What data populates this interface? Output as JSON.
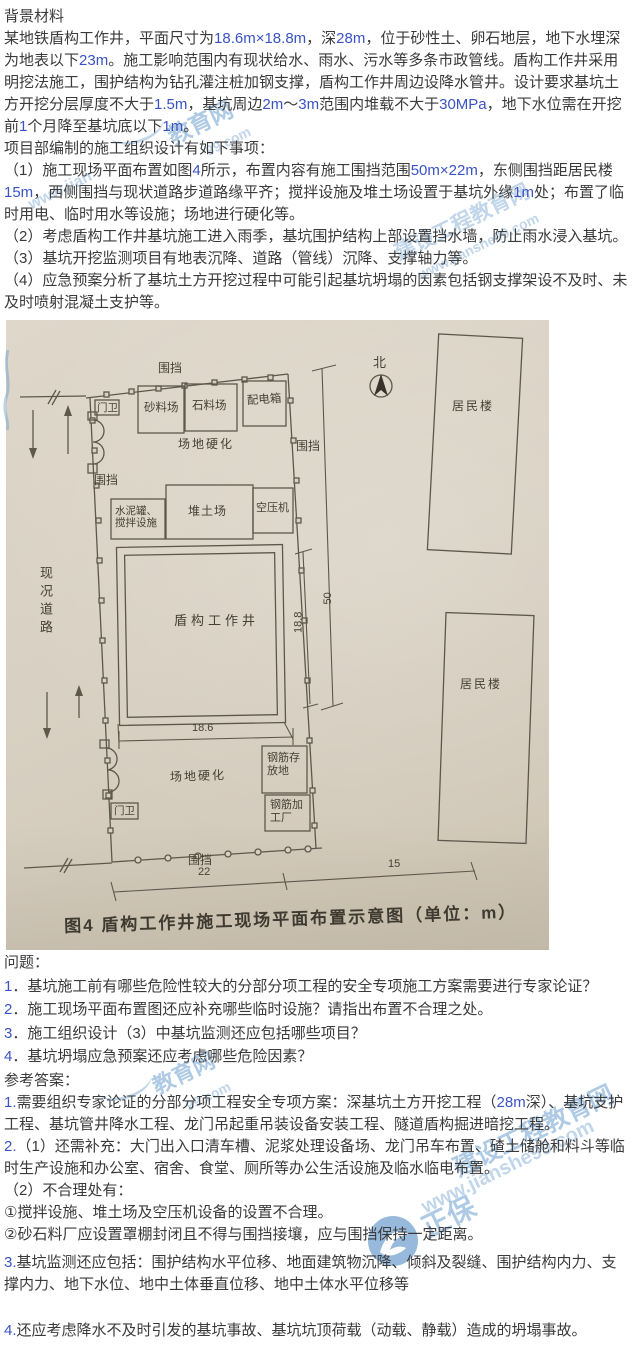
{
  "colors": {
    "accent_blue": "#3a53c4",
    "body_text": "#3a3a3a",
    "watermark_blue": "#6c9ece",
    "photo_paper": "#d8d0c2",
    "diagram_ink": "#5e584c"
  },
  "background": {
    "heading": "背景材料",
    "para1": [
      {
        "t": "某地铁盾构工作井，平面尺寸为"
      },
      {
        "t": "18.6m×18.8m",
        "b": true
      },
      {
        "t": "，深"
      },
      {
        "t": "28m",
        "b": true
      },
      {
        "t": "，位于砂性土、卵石地层，地下水埋深为地表以下"
      },
      {
        "t": "23m",
        "b": true
      },
      {
        "t": "。施工影响范围内有现状给水、雨水、污水等多条市政管线。盾构工作井采用明挖法施工，围护结构为钻孔灌注桩加钢支撑，盾构工作井周边设降水管井。设计要求基坑土方开挖分层厚度不大于"
      },
      {
        "t": "1.5m",
        "b": true
      },
      {
        "t": "，基坑周边"
      },
      {
        "t": "2m",
        "b": true
      },
      {
        "t": "～"
      },
      {
        "t": "3m",
        "b": true
      },
      {
        "t": "范围内堆载不大于"
      },
      {
        "t": "30MPa",
        "b": true
      },
      {
        "t": "，地下水位需在开挖前"
      },
      {
        "t": "1",
        "b": true
      },
      {
        "t": "个月降至基坑底以下"
      },
      {
        "t": "1m",
        "b": true
      },
      {
        "t": "。"
      }
    ],
    "para2": "项目部编制的施工组织设计有如下事项：",
    "item1": [
      {
        "t": "（1）施工现场平面布置如图"
      },
      {
        "t": "4",
        "b": true
      },
      {
        "t": "所示，布置内容有施工围挡范围"
      },
      {
        "t": "50m×22m",
        "b": true
      },
      {
        "t": "，东侧围挡距居民楼"
      },
      {
        "t": "15m",
        "b": true
      },
      {
        "t": "，西侧围挡与现状道路步道路缘平齐；搅拌设施及堆土场设置于基坑外缘"
      },
      {
        "t": "1m",
        "b": true
      },
      {
        "t": "处；布置了临时用电、临时用水等设施；场地进行硬化等。"
      }
    ],
    "item2": [
      {
        "t": "（2）考虑盾构工作井基坑施工进入雨季，基坑围护结构上部设置挡水墙，防止雨水浸入基坑。"
      }
    ],
    "item3": [
      {
        "t": "（3）基坑开挖监测项目有地表沉降、道路（管线）沉降、支撑轴力等。"
      }
    ],
    "item4": [
      {
        "t": "（4）应急预案分析了基坑土方开挖过程中可能引起基坑坍塌的因素包括钢支撑架设不及时、未及时喷射混凝土支护等。"
      }
    ]
  },
  "figure": {
    "caption": "图4  盾构工作井施工现场平面布置示意图（单位：m）",
    "north": "北",
    "road": "现况道路",
    "fence": "围挡",
    "guard": "门卫",
    "sand_yard": "砂料场",
    "stone_yard": "石料场",
    "power_box": "配电箱",
    "harden": "场地硬化",
    "cement_mix": "水泥罐、搅拌设施",
    "soil_yard": "堆土场",
    "compressor": "空压机",
    "shaft": "盾构工作井",
    "rebar_storage": "钢筋存放地",
    "rebar_plant": "钢筋加工厂",
    "residential": "居民楼",
    "dim_site_ns": "50",
    "dim_shaft_ns": "18.8",
    "dim_shaft_ew": "18.6",
    "dim_site_ew": "22",
    "dim_east_offset": "15"
  },
  "questions": {
    "heading": "问题：",
    "q1": [
      {
        "t": "1",
        "b": true
      },
      {
        "t": "．基坑施工前有哪些危险性较大的分部分项工程的安全专项施工方案需要进行专家论证？"
      }
    ],
    "q2": [
      {
        "t": "2",
        "b": true
      },
      {
        "t": "．施工现场平面布置图还应补充哪些临时设施？请指出布置不合理之处。"
      }
    ],
    "q3": [
      {
        "t": "3",
        "b": true
      },
      {
        "t": "．施工组织设计（3）中基坑监测还应包括哪些项目？"
      }
    ],
    "q4": [
      {
        "t": "4",
        "b": true
      },
      {
        "t": "．基坑坍塌应急预案还应考虑哪些危险因素？"
      }
    ]
  },
  "answers": {
    "heading": "参考答案：",
    "a1": [
      {
        "t": "1.",
        "b": true
      },
      {
        "t": "需要组织专家论证的分部分项工程安全专项方案：深基坑土方开挖工程（"
      },
      {
        "t": "28m",
        "b": true
      },
      {
        "t": "深）、基坑支护工程、基坑管井降水工程、龙门吊起重吊装设备安装工程、隧道盾构掘进暗挖工程。"
      }
    ],
    "a2": [
      {
        "t": "2.",
        "b": true
      },
      {
        "t": "（1）还需补充：大门出入口清车槽、泥浆处理设备场、龙门吊车布置、碴土储舱和料斗等临时生产设施和办公室、宿舍、食堂、厕所等办公生活设施及临水临电布置。"
      }
    ],
    "a2_sub": [
      {
        "t": "（2）不合理处有："
      }
    ],
    "a2_p1": [
      {
        "t": "①搅拌设施、堆土场及空压机设备的设置不合理。"
      }
    ],
    "a2_p2": [
      {
        "t": "②砂石料厂应设置罩棚封闭且不得与围挡接壤，应与围挡保持一定距离。"
      }
    ],
    "a3": [
      {
        "t": "3.",
        "b": true
      },
      {
        "t": "基坑监测还应包括：围护结构水平位移、地面建筑物沉降、倾斜及裂缝、围护结构内力、支撑内力、地下水位、地中土体垂直位移、地中土体水平位移等"
      }
    ],
    "a4": [
      {
        "t": "4.",
        "b": true
      },
      {
        "t": "还应考虑降水不及时引发的基坑事故、基坑坑顶荷载（动载、静载）造成的坍塌事故。"
      }
    ]
  },
  "watermark": {
    "brand": "正保",
    "site": "建设工程教育网",
    "url": "www.jianshe99.com",
    "frag_edu": "教育网",
    "frag_dotcom": "99.com",
    "frag_www": "www.jian"
  }
}
